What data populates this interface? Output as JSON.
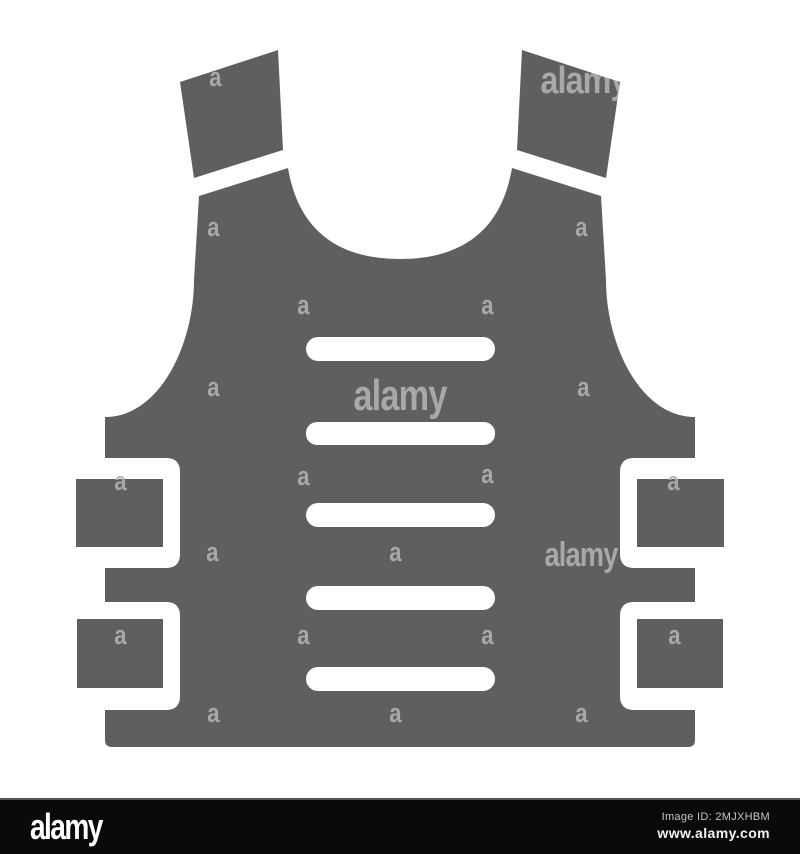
{
  "image": {
    "subject": "bulletproof-vest-glyph-icon",
    "colors": {
      "vest": "#5f5f5f",
      "watermark": "#b3b3b3",
      "background": "#ffffff",
      "footer_bg": "#0a0a0a",
      "footer_border": "#565656",
      "logo_text": "#ffffff",
      "image_id_text": "#c6c6c6",
      "url_text": "#f4f4f4"
    }
  },
  "watermarks": {
    "letter": "a",
    "word": "alamy",
    "items": [
      {
        "type": "letter",
        "x": 215,
        "y": 86,
        "size": 26,
        "sx": 0.85
      },
      {
        "type": "word",
        "x": 584,
        "y": 93,
        "size": 38,
        "sx": 0.85
      },
      {
        "type": "letter",
        "x": 213,
        "y": 236,
        "size": 26,
        "sx": 0.85
      },
      {
        "type": "letter",
        "x": 581,
        "y": 236,
        "size": 26,
        "sx": 0.85
      },
      {
        "type": "letter",
        "x": 303,
        "y": 314,
        "size": 26,
        "sx": 0.85
      },
      {
        "type": "letter",
        "x": 487,
        "y": 314,
        "size": 26,
        "sx": 0.85
      },
      {
        "type": "letter",
        "x": 213,
        "y": 396,
        "size": 26,
        "sx": 0.85
      },
      {
        "type": "word",
        "x": 400,
        "y": 410,
        "size": 44,
        "sx": 0.78
      },
      {
        "type": "letter",
        "x": 583,
        "y": 396,
        "size": 26,
        "sx": 0.85
      },
      {
        "type": "letter",
        "x": 120,
        "y": 490,
        "size": 26,
        "sx": 0.85
      },
      {
        "type": "letter",
        "x": 303,
        "y": 485,
        "size": 26,
        "sx": 0.85
      },
      {
        "type": "letter",
        "x": 487,
        "y": 483,
        "size": 26,
        "sx": 0.85
      },
      {
        "type": "letter",
        "x": 673,
        "y": 490,
        "size": 26,
        "sx": 0.85
      },
      {
        "type": "letter",
        "x": 212,
        "y": 561,
        "size": 26,
        "sx": 0.85
      },
      {
        "type": "letter",
        "x": 395,
        "y": 561,
        "size": 26,
        "sx": 0.85
      },
      {
        "type": "word",
        "x": 581,
        "y": 566,
        "size": 34,
        "sx": 0.8
      },
      {
        "type": "letter",
        "x": 120,
        "y": 644,
        "size": 26,
        "sx": 0.85
      },
      {
        "type": "letter",
        "x": 303,
        "y": 644,
        "size": 26,
        "sx": 0.85
      },
      {
        "type": "letter",
        "x": 487,
        "y": 644,
        "size": 26,
        "sx": 0.85
      },
      {
        "type": "letter",
        "x": 674,
        "y": 644,
        "size": 26,
        "sx": 0.85
      },
      {
        "type": "letter",
        "x": 213,
        "y": 722,
        "size": 26,
        "sx": 0.85
      },
      {
        "type": "letter",
        "x": 395,
        "y": 722,
        "size": 26,
        "sx": 0.85
      },
      {
        "type": "letter",
        "x": 581,
        "y": 722,
        "size": 26,
        "sx": 0.85
      }
    ]
  },
  "footer": {
    "logo": "alamy",
    "image_id": "Image ID: 2MJXHBM",
    "url": "www.alamy.com"
  }
}
